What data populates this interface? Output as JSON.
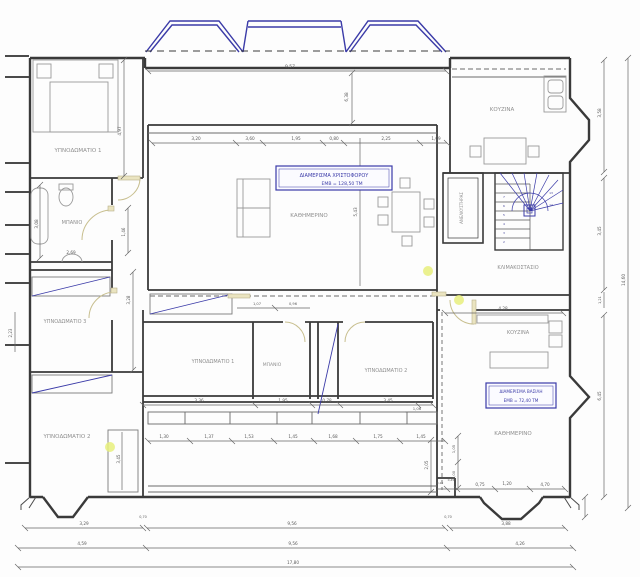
{
  "apartment_boxes": [
    {
      "line1": "ΔΙΑΜΕΡΙΣΜΑ ΧΡΙΣΤΟΦΟΡΟΥ",
      "line2": "ΕΜΒ = 128,50 ΤΜ"
    },
    {
      "line1": "ΔΙΑΜΕΡΙΣΜΑ ΒΑΣΙΛΗ",
      "line2": "ΕΜΒ = 72,40 ΤΜ"
    }
  ],
  "rooms": {
    "bedroom1_left": "ΥΠΝΟΔΩΜΑΤΙΟ 1",
    "bathroom_left": "ΜΠΑΝΙΟ",
    "bedroom3_left": "ΥΠΝΟΔΩΜΑΤΙΟ 3",
    "bedroom2_left": "ΥΠΝΟΔΩΜΑΤΙΟ 2",
    "living_main": "ΚΑΘΗΜΕΡΙΝΟ",
    "kitchen_top": "ΚΟΥΖΙΝΑ",
    "elevator": "ΑΝΕΛΚΥΣΤΗΡΑΣ",
    "stairwell": "ΚΛΙΜΑΚΟΣΤΑΣΙΟ",
    "bedroom1_mid": "ΥΠΝΟΔΩΜΑΤΙΟ 1",
    "bathroom_mid": "ΜΠΑΝΙΟ",
    "bedroom2_mid": "ΥΠΝΟΔΩΜΑΤΙΟ 2",
    "kitchen_right": "ΚΟΥΖΙΝΑ",
    "living_right": "ΚΑΘΗΜΕΡΙΝΟ"
  },
  "dims": {
    "top_width": "9,57",
    "veranda_h": "6,38",
    "bed1_h": "4,97",
    "row_top": [
      "3,20",
      "3,60",
      "1,95",
      "0,80",
      "2,25",
      "1,09"
    ],
    "right_kitchen_h": "3,58",
    "right_stair_h": "3,45",
    "right_small": "1,21",
    "right_total": "14,60",
    "right_living_h": "6,45",
    "kitchen_right_w": "4,28",
    "bath_left_h": "3,08",
    "bath_left_w": "2,69",
    "corridor_w": "1,46",
    "corridor_h": "3,28",
    "bed3_h": "2,23",
    "living_h": "5,43",
    "mid_top_a": "1,07",
    "mid_top_b": "0,96",
    "row_mid": [
      "3,36",
      "1,95",
      "0,78",
      "3,45"
    ],
    "mid_small": "1,06",
    "row_mid2": [
      "1,30",
      "1,37",
      "1,53",
      "1,45",
      "1,68",
      "1,75",
      "1,45"
    ],
    "closet_h": "3,45",
    "step_h": "2,05",
    "v105": "1,05",
    "v100": "1,00",
    "br_tiny_a": "0,10",
    "br_tiny_b": "0,45",
    "row_br": [
      "0,75",
      "1,20",
      "4,70"
    ],
    "row_a": [
      "3,29",
      "0,70",
      "9,56",
      "0,70",
      "3,88"
    ],
    "row_b": [
      "4,59",
      "9,56",
      "4,26"
    ],
    "total_w": "17,80"
  },
  "stairs": {
    "step_numbers": [
      "2",
      "3",
      "4",
      "5",
      "6",
      "7",
      "13",
      "14"
    ]
  },
  "colors": {
    "wall": "#3a3a3a",
    "accent_blue": "#3b3ba8",
    "door_tan": "#c8bf8f",
    "furniture": "#9a9a9a",
    "highlight": "#e8f07d"
  }
}
